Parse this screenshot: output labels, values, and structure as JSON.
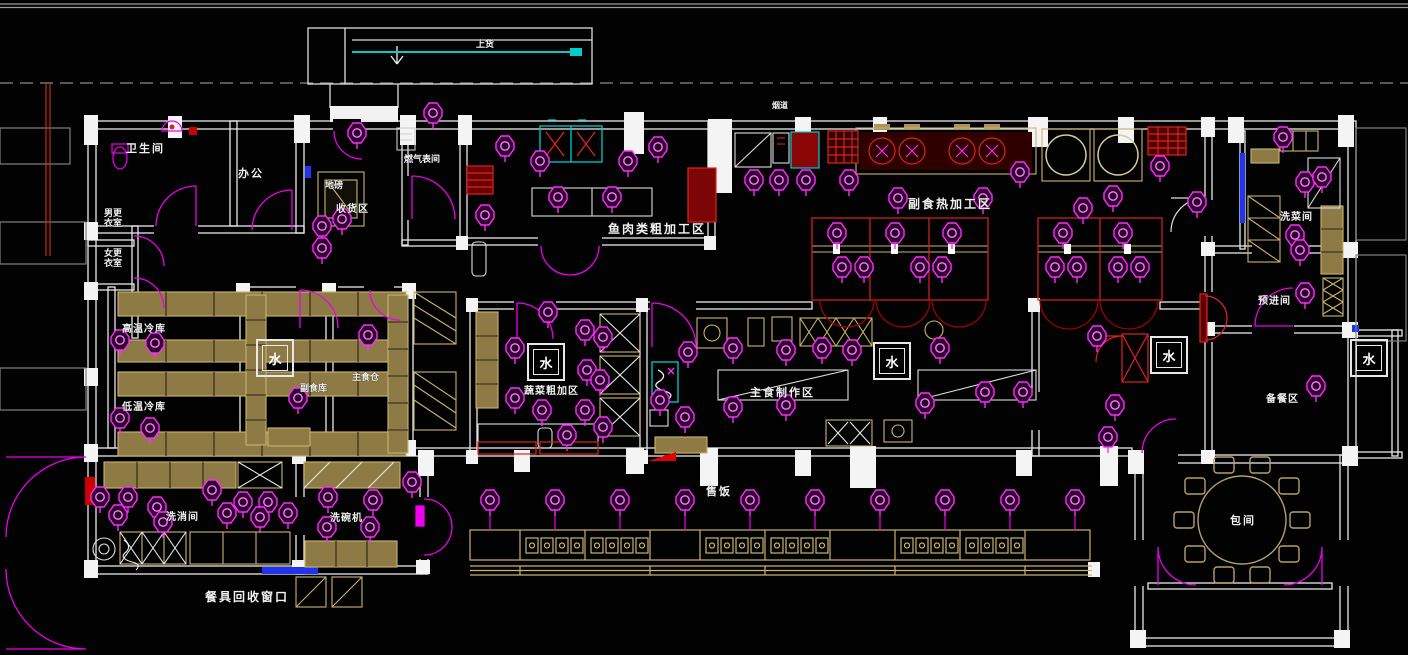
{
  "labels": {
    "restroom": "卫生间",
    "office": "办公",
    "mens_changing_room": "男更衣室",
    "womens_changing_room": "女更衣室",
    "floor_scale": "地磅",
    "receiving_area": "收货区",
    "gas_meter_room": "燃气表间",
    "fish_meat_rough_prep_area": "鱼肉类粗加工区",
    "flue": "烟道",
    "side_dish_hot_cooking_area": "副食热加工区",
    "vegetable_washing_room": "洗菜间",
    "pre_entry_room": "预进间",
    "serving_prep_area": "备餐区",
    "high_temp_cold_storage": "高温冷库",
    "low_temp_cold_storage": "低温冷库",
    "side_dish_storage": "副食库",
    "staple_food_storage": "主食仓",
    "vegetable_rough_prep_area": "蔬菜粗加区",
    "staple_food_production_area": "主食制作区",
    "washing_disinfection_room": "洗消间",
    "dishwasher": "洗碗机",
    "tableware_return_window": "餐具回收窗口",
    "meal_serving": "售饭",
    "private_dining_room": "包间",
    "ramp_up": "上货",
    "water_marker": "水"
  },
  "colors": {
    "background": "#000000",
    "walls": "#e8e8e8",
    "doors": "#ee00ee",
    "fixtures": "#ff2bff",
    "equipment_wood": "#a9945a",
    "hot_equipment_red": "#dd2222",
    "water_line_cyan": "#00cccc",
    "window_blue": "#2233ee",
    "boundary_gray": "#8a8a8a",
    "label_text": "#f2f2f2"
  }
}
